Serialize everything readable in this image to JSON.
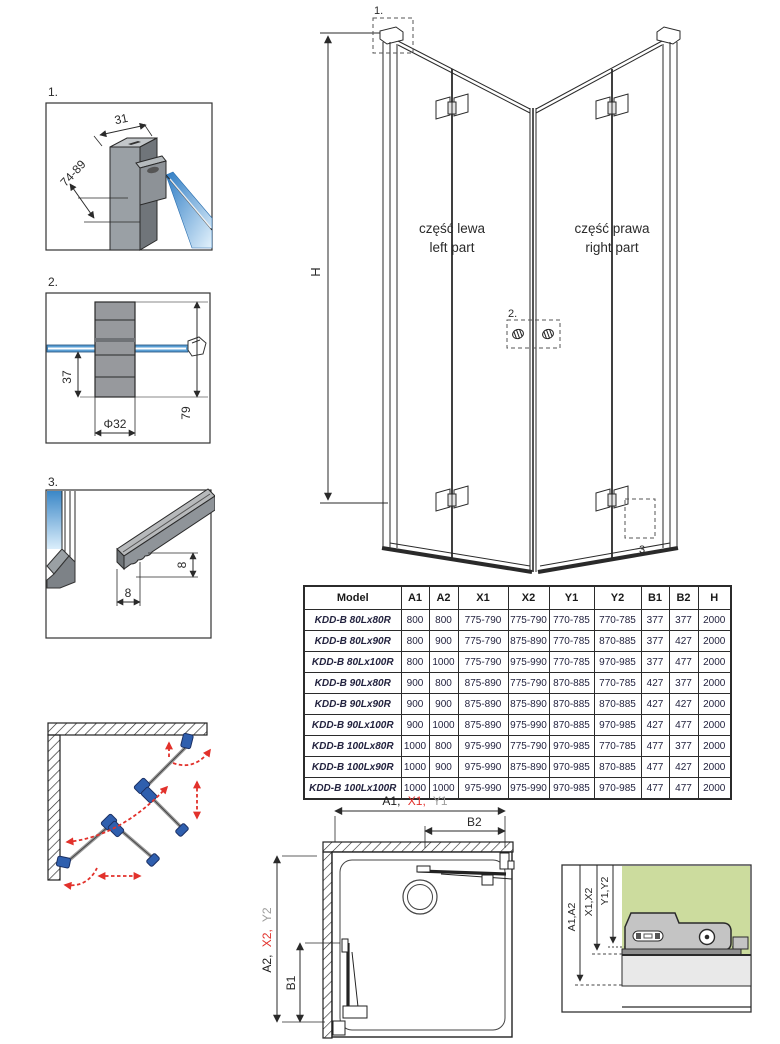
{
  "colors": {
    "line": "#2a2a2a",
    "red": "#e2312b",
    "gray": "#9d9d9c",
    "blue": "#1d4f9e",
    "value_navy": "#23233f",
    "glass_blue": "#3b87c7",
    "wall_green": "#ccdc9e",
    "hinge_blue": "#2f5fae"
  },
  "details": {
    "d1": {
      "num": "1.",
      "dim_top": "31",
      "dim_side": "74-89"
    },
    "d2": {
      "num": "2.",
      "dim_depth": "37",
      "dim_dia": "Φ32",
      "dim_height": "79"
    },
    "d3": {
      "num": "3.",
      "dim_w": "8",
      "dim_h": "8"
    }
  },
  "elevation": {
    "h": "H",
    "callout_1": "1.",
    "callout_2": "2.",
    "callout_3": "3.",
    "left_pl": "część lewa",
    "left_en": "left part",
    "right_pl": "część prawa",
    "right_en": "right part"
  },
  "plan": {
    "top_a1": "A1,",
    "top_x1": "X1,",
    "top_y1": "Y1",
    "b2": "B2",
    "left_a2": "A2,",
    "left_x2": "X2,",
    "left_y2": "Y2",
    "b1": "B1"
  },
  "wall_detail": {
    "a": "A1,A2",
    "x": "X1,X2",
    "y": "Y1,Y2"
  },
  "table": {
    "headers": [
      "Model",
      "A1",
      "A2",
      "X1",
      "X2",
      "Y1",
      "Y2",
      "B1",
      "B2",
      "H"
    ],
    "rows": [
      [
        "KDD-B 80Lx80R",
        "800",
        "800",
        "775-790",
        "775-790",
        "770-785",
        "770-785",
        "377",
        "377",
        "2000"
      ],
      [
        "KDD-B 80Lx90R",
        "800",
        "900",
        "775-790",
        "875-890",
        "770-785",
        "870-885",
        "377",
        "427",
        "2000"
      ],
      [
        "KDD-B 80Lx100R",
        "800",
        "1000",
        "775-790",
        "975-990",
        "770-785",
        "970-985",
        "377",
        "477",
        "2000"
      ],
      [
        "KDD-B 90Lx80R",
        "900",
        "800",
        "875-890",
        "775-790",
        "870-885",
        "770-785",
        "427",
        "377",
        "2000"
      ],
      [
        "KDD-B 90Lx90R",
        "900",
        "900",
        "875-890",
        "875-890",
        "870-885",
        "870-885",
        "427",
        "427",
        "2000"
      ],
      [
        "KDD-B 90Lx100R",
        "900",
        "1000",
        "875-890",
        "975-990",
        "870-885",
        "970-985",
        "427",
        "477",
        "2000"
      ],
      [
        "KDD-B 100Lx80R",
        "1000",
        "800",
        "975-990",
        "775-790",
        "970-985",
        "770-785",
        "477",
        "377",
        "2000"
      ],
      [
        "KDD-B 100Lx90R",
        "1000",
        "900",
        "975-990",
        "875-890",
        "970-985",
        "870-885",
        "477",
        "427",
        "2000"
      ],
      [
        "KDD-B 100Lx100R",
        "1000",
        "1000",
        "975-990",
        "975-990",
        "970-985",
        "970-985",
        "477",
        "477",
        "2000"
      ]
    ]
  }
}
